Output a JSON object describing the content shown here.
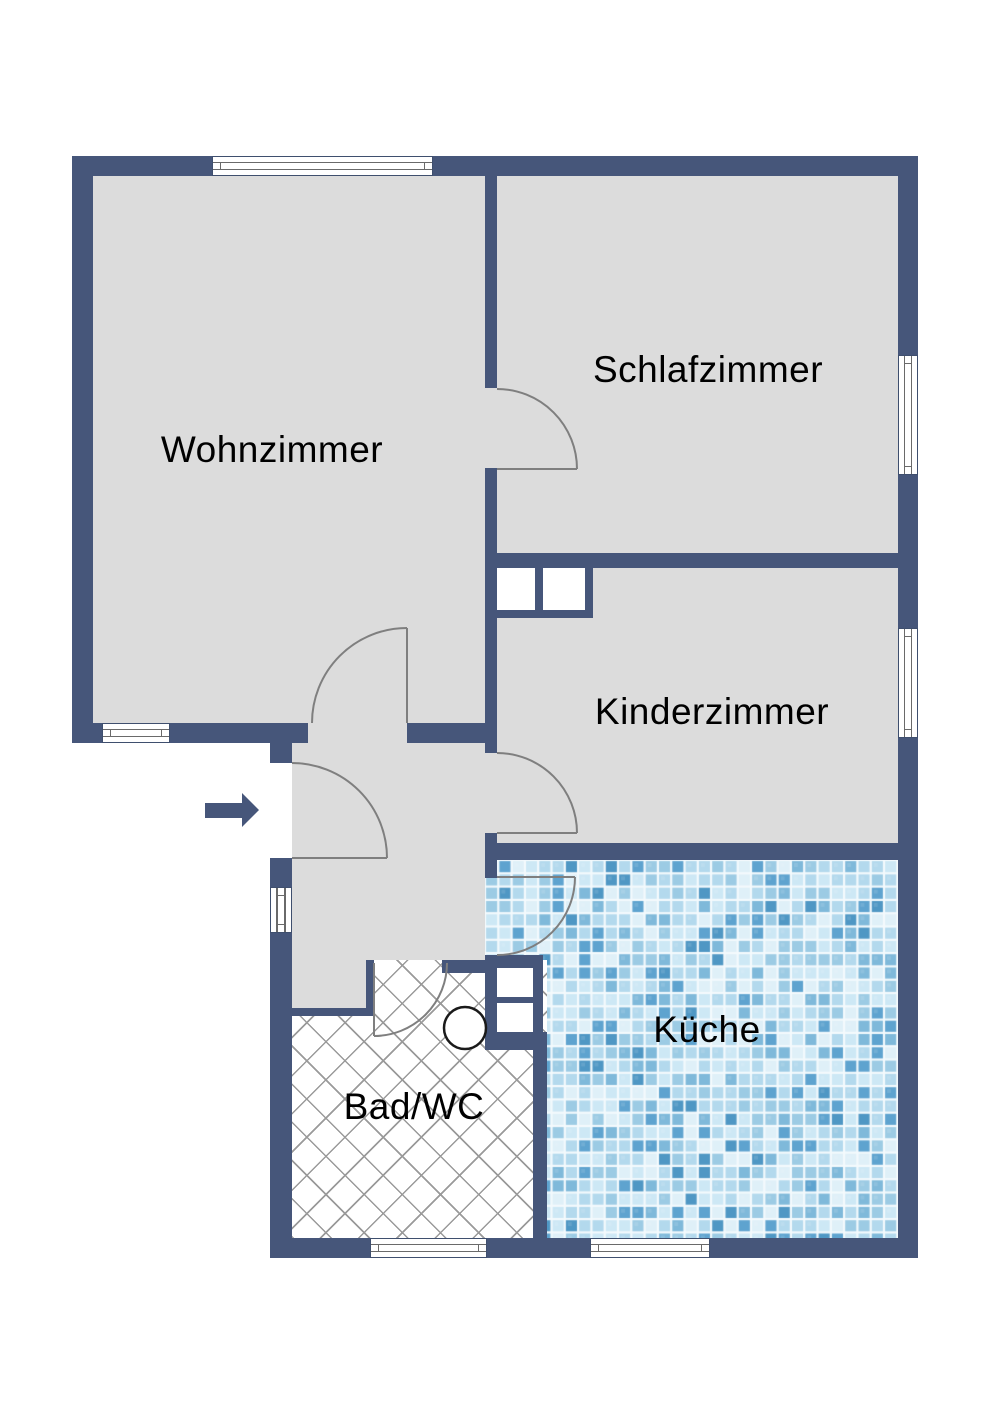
{
  "floorplan": {
    "rooms": [
      {
        "id": "wohnzimmer",
        "label": "Wohnzimmer"
      },
      {
        "id": "schlafzimmer",
        "label": "Schlafzimmer"
      },
      {
        "id": "kinderzimmer",
        "label": "Kinderzimmer"
      },
      {
        "id": "kueche",
        "label": "Küche"
      },
      {
        "id": "bad-wc",
        "label": "Bad/WC"
      }
    ],
    "entry_arrow": {
      "direction": "right"
    },
    "colors": {
      "wall": "#46567a",
      "floor": "#dcdcdc",
      "door_arc": "#7f7f7f",
      "hatch_line": "#9a9a9a",
      "window_frame": "#3f4f6e",
      "tile_palette": [
        "#dff0f8",
        "#cde8f5",
        "#b3d9ed",
        "#9ccbe4",
        "#7fb9da",
        "#5ea3cf",
        "#4f97c4"
      ],
      "tile_weights": [
        2,
        3,
        4,
        3,
        2,
        1.5,
        0.8
      ]
    }
  }
}
